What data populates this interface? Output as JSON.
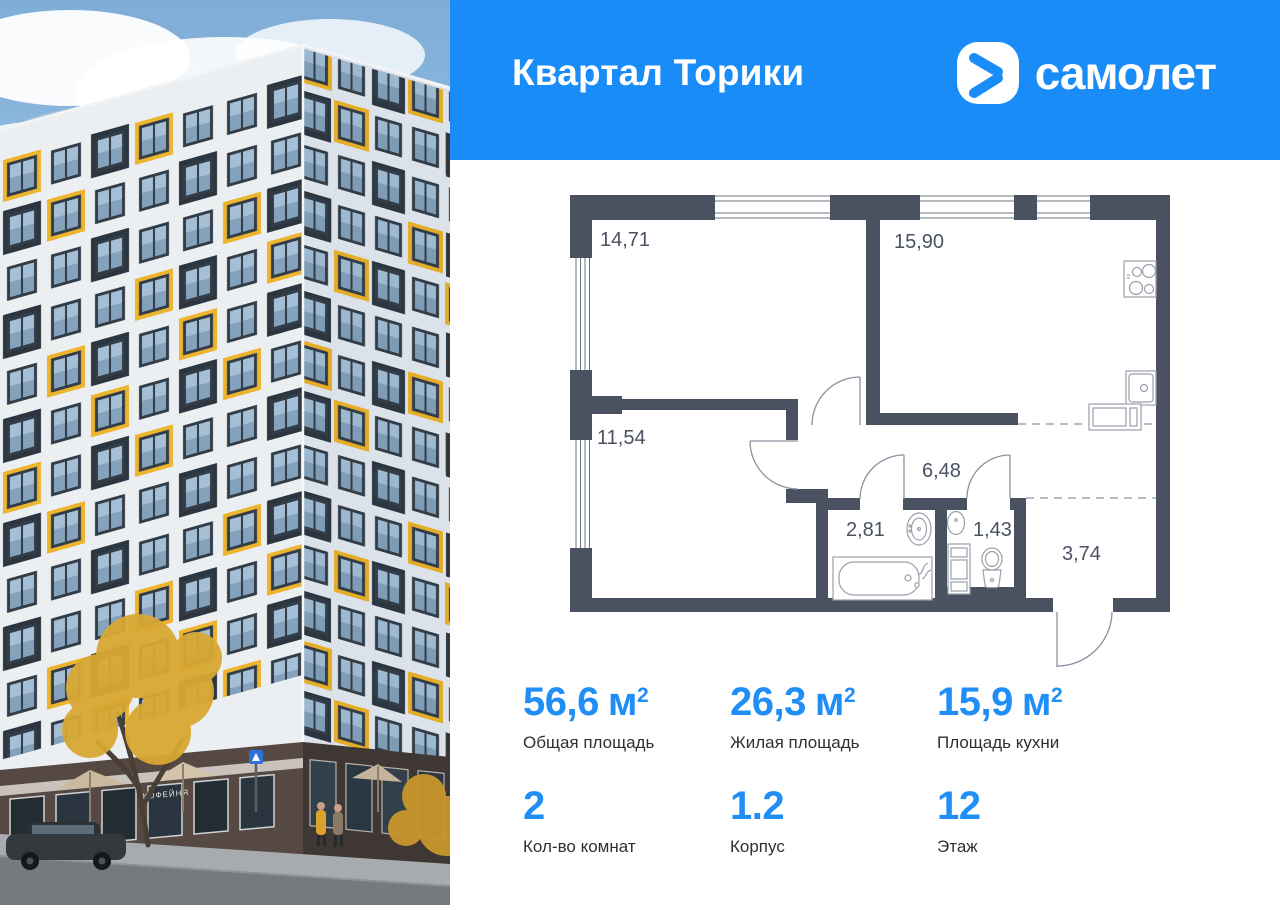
{
  "header": {
    "title": "Квартал Торики",
    "brand_wordmark": "самолет"
  },
  "colors": {
    "brand_blue": "#1a8cf8",
    "number_blue": "#1f8ef7",
    "wall_dark": "#4a5261",
    "accent_yellow": "#edb42d"
  },
  "photo": {
    "shop_sign": "КОФЕЙНЯ"
  },
  "floorplan": {
    "room_labels": [
      {
        "id": "room-14-71",
        "area": "14,71"
      },
      {
        "id": "kitchen-15-90",
        "area": "15,90"
      },
      {
        "id": "room-11-54",
        "area": "11,54"
      },
      {
        "id": "hall-6-48",
        "area": "6,48"
      },
      {
        "id": "bathroom-2-81",
        "area": "2,81"
      },
      {
        "id": "wc-1-43",
        "area": "1,43"
      },
      {
        "id": "corridor-3-74",
        "area": "3,74"
      }
    ],
    "fixtures": [
      "stove",
      "kitchen-sink",
      "microwave",
      "bathtub",
      "bath-sink",
      "washing-machine",
      "wc-sink",
      "toilet"
    ]
  },
  "stats": {
    "cells": [
      {
        "value": "56,6",
        "unit": "м",
        "sup": "2",
        "label": "Общая площадь"
      },
      {
        "value": "26,3",
        "unit": "м",
        "sup": "2",
        "label": "Жилая площадь"
      },
      {
        "value": "15,9",
        "unit": "м",
        "sup": "2",
        "label": "Площадь кухни"
      },
      {
        "value": "2",
        "unit": "",
        "sup": "",
        "label": "Кол-во комнат"
      },
      {
        "value": "1.2",
        "unit": "",
        "sup": "",
        "label": "Корпус"
      },
      {
        "value": "12",
        "unit": "",
        "sup": "",
        "label": "Этаж"
      }
    ]
  }
}
